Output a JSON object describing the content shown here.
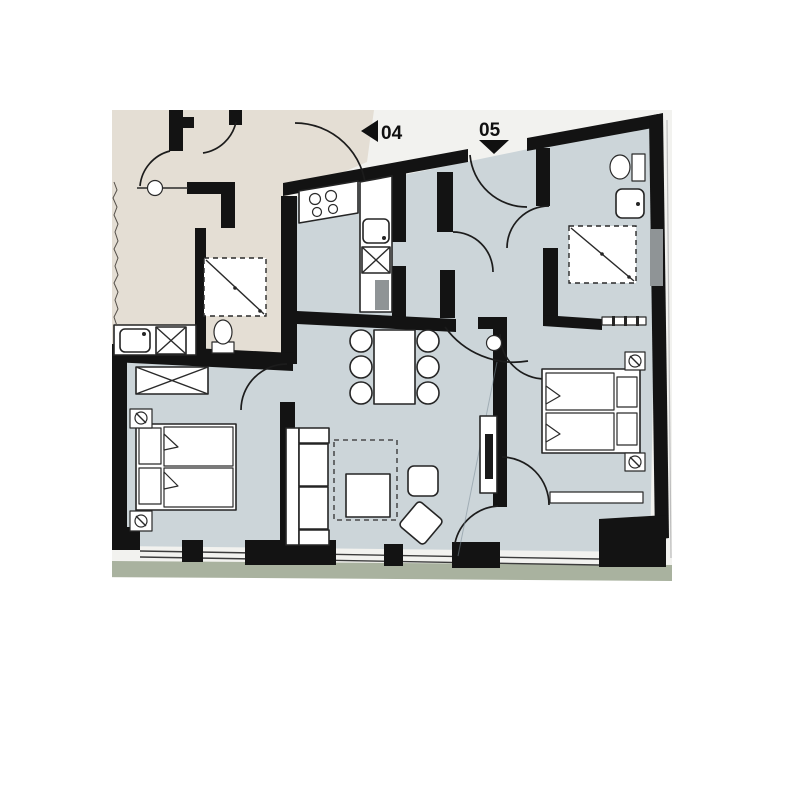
{
  "units": [
    {
      "label": "04",
      "marker": "arrow-left"
    },
    {
      "label": "05",
      "marker": "arrow-down"
    }
  ],
  "palette": {
    "background": "#ffffff",
    "plan-bg": "#f2f2ef",
    "unit04-floor": "#e4ded4",
    "unit05-floor": "#ccd5d9",
    "walls": "#131313",
    "grass": "#a9b29f",
    "accent-gray": "#8f9496",
    "label-color": "#101010"
  }
}
